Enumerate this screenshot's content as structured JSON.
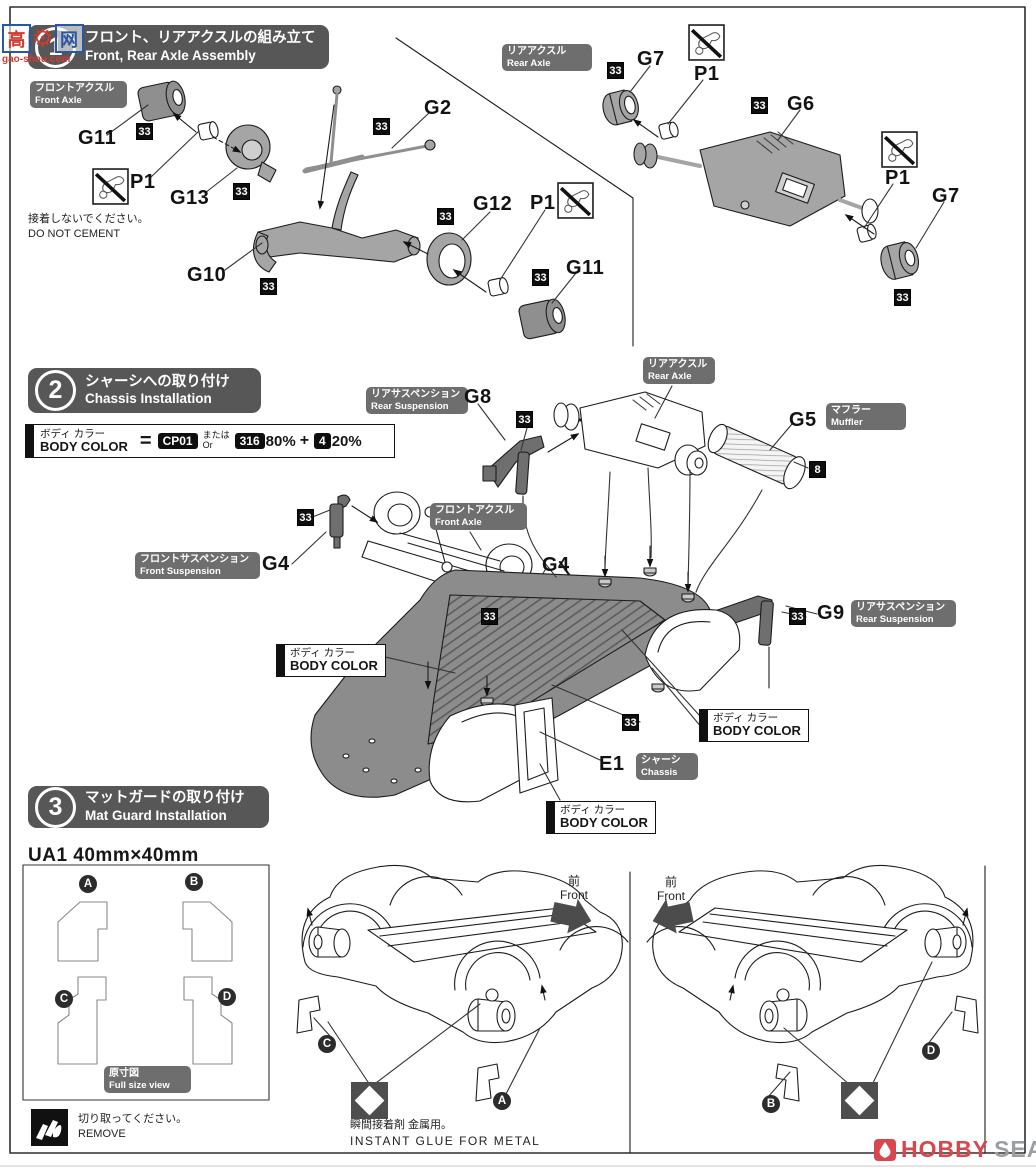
{
  "watermark": {
    "char1": "高",
    "char2": "网",
    "site": "gao-shou.com"
  },
  "footer_logo": {
    "word1": "HOBBY",
    "word2": "SEARCH"
  },
  "colors": {
    "header_gray": "#575757",
    "label_gray": "#6e6e6e",
    "badge_black": "#0e0e0e",
    "logo_red": "#d8474b",
    "logo_gray": "#9b9fa3",
    "watermark_red": "#d23a2f",
    "watermark_blue": "#2a57a5"
  },
  "steps": [
    {
      "num": "1",
      "jp": "フロント、リアアクスルの組み立て",
      "en": "Front, Rear Axle Assembly"
    },
    {
      "num": "2",
      "jp": "シャーシへの取り付け",
      "en": "Chassis Installation"
    },
    {
      "num": "3",
      "jp": "マットガードの取り付け",
      "en": "Mat Guard Installation"
    }
  ],
  "legend": {
    "jp": "ボディ カラー",
    "en": "BODY COLOR",
    "equals": "=",
    "paint1": "CP01",
    "or_jp": "または",
    "or_en": "Or",
    "paint2": "316",
    "pct2": "80%",
    "plus": "+",
    "paint3": "4",
    "pct3": "20%"
  },
  "body_color_label": {
    "jp": "ボディ カラー",
    "en": "BODY COLOR"
  },
  "notes": {
    "dnc_jp": "接着しないでください。",
    "dnc_en": "DO NOT CEMENT",
    "remove_jp": "切り取ってください。",
    "remove_en": "REMOVE",
    "glue_jp": "瞬間接着剤 金属用。",
    "glue_en": "INSTANT GLUE FOR METAL"
  },
  "ua1": {
    "title": "UA1  40mm×40mm"
  },
  "front_marker": {
    "jp": "前",
    "en": "Front"
  },
  "area_labels": [
    {
      "jp": "フロントアクスル",
      "en": "Front Axle",
      "x": 30,
      "y": 81,
      "w": 97
    },
    {
      "jp": "リアアクスル",
      "en": "Rear Axle",
      "x": 502,
      "y": 44,
      "w": 90
    },
    {
      "jp": "リアサスペンション",
      "en": "Rear Suspension",
      "x": 366,
      "y": 387,
      "w": 102
    },
    {
      "jp": "リアアクスル",
      "en": "Rear Axle",
      "x": 643,
      "y": 357,
      "w": 72
    },
    {
      "jp": "マフラー",
      "en": "Muffler",
      "x": 826,
      "y": 403,
      "w": 80
    },
    {
      "jp": "フロントアクスル",
      "en": "Front Axle",
      "x": 430,
      "y": 503,
      "w": 97
    },
    {
      "jp": "フロントサスペンション",
      "en": "Front Suspension",
      "x": 135,
      "y": 552,
      "w": 125
    },
    {
      "jp": "リアサスペンション",
      "en": "Rear Suspension",
      "x": 851,
      "y": 600,
      "w": 105
    },
    {
      "jp": "シャーシ",
      "en": "Chassis",
      "x": 636,
      "y": 753,
      "w": 62
    },
    {
      "jp": "原寸図",
      "en": "Full size view",
      "x": 104,
      "y": 1066,
      "w": 87
    }
  ],
  "part_labels": [
    {
      "text": "G11",
      "x": 78,
      "y": 127
    },
    {
      "text": "P1",
      "x": 130,
      "y": 171
    },
    {
      "text": "G13",
      "x": 170,
      "y": 187
    },
    {
      "text": "G10",
      "x": 187,
      "y": 264
    },
    {
      "text": "G2",
      "x": 424,
      "y": 97
    },
    {
      "text": "G12",
      "x": 473,
      "y": 193
    },
    {
      "text": "P1",
      "x": 530,
      "y": 192
    },
    {
      "text": "G11",
      "x": 566,
      "y": 257
    },
    {
      "text": "G7",
      "x": 637,
      "y": 48
    },
    {
      "text": "P1",
      "x": 694,
      "y": 63
    },
    {
      "text": "G6",
      "x": 787,
      "y": 93
    },
    {
      "text": "P1",
      "x": 885,
      "y": 167
    },
    {
      "text": "G7",
      "x": 932,
      "y": 185
    },
    {
      "text": "G8",
      "x": 464,
      "y": 386
    },
    {
      "text": "G5",
      "x": 789,
      "y": 409
    },
    {
      "text": "G4",
      "x": 262,
      "y": 553
    },
    {
      "text": "G4",
      "x": 542,
      "y": 554
    },
    {
      "text": "G9",
      "x": 817,
      "y": 602
    },
    {
      "text": "E1",
      "x": 599,
      "y": 753
    }
  ],
  "badges": [
    {
      "t": "33",
      "x": 136,
      "y": 123
    },
    {
      "t": "33",
      "x": 233,
      "y": 183
    },
    {
      "t": "33",
      "x": 373,
      "y": 118
    },
    {
      "t": "33",
      "x": 260,
      "y": 278
    },
    {
      "t": "33",
      "x": 437,
      "y": 208
    },
    {
      "t": "33",
      "x": 532,
      "y": 269
    },
    {
      "t": "33",
      "x": 607,
      "y": 62
    },
    {
      "t": "33",
      "x": 751,
      "y": 97
    },
    {
      "t": "33",
      "x": 894,
      "y": 289
    },
    {
      "t": "33",
      "x": 516,
      "y": 411
    },
    {
      "t": "33",
      "x": 297,
      "y": 509
    },
    {
      "t": "33",
      "x": 481,
      "y": 608
    },
    {
      "t": "33",
      "x": 622,
      "y": 714
    },
    {
      "t": "33",
      "x": 789,
      "y": 608
    },
    {
      "t": "8",
      "x": 809,
      "y": 461
    }
  ],
  "circle_letters": [
    {
      "t": "A",
      "x": 88,
      "y": 884
    },
    {
      "t": "B",
      "x": 194,
      "y": 882
    },
    {
      "t": "C",
      "x": 64,
      "y": 999
    },
    {
      "t": "D",
      "x": 227,
      "y": 997
    },
    {
      "t": "C",
      "x": 327,
      "y": 1044
    },
    {
      "t": "A",
      "x": 502,
      "y": 1101
    },
    {
      "t": "B",
      "x": 771,
      "y": 1104
    },
    {
      "t": "D",
      "x": 931,
      "y": 1051
    }
  ],
  "body_color_boxes": [
    {
      "x": 276,
      "y": 644
    },
    {
      "x": 699,
      "y": 709
    },
    {
      "x": 546,
      "y": 801
    }
  ],
  "dnc_icons": [
    {
      "x": 92,
      "y": 168
    },
    {
      "x": 557,
      "y": 182
    },
    {
      "x": 688,
      "y": 24
    },
    {
      "x": 881,
      "y": 131
    }
  ],
  "diamond_icons": [
    {
      "x": 351,
      "y": 1082
    },
    {
      "x": 841,
      "y": 1082
    }
  ]
}
